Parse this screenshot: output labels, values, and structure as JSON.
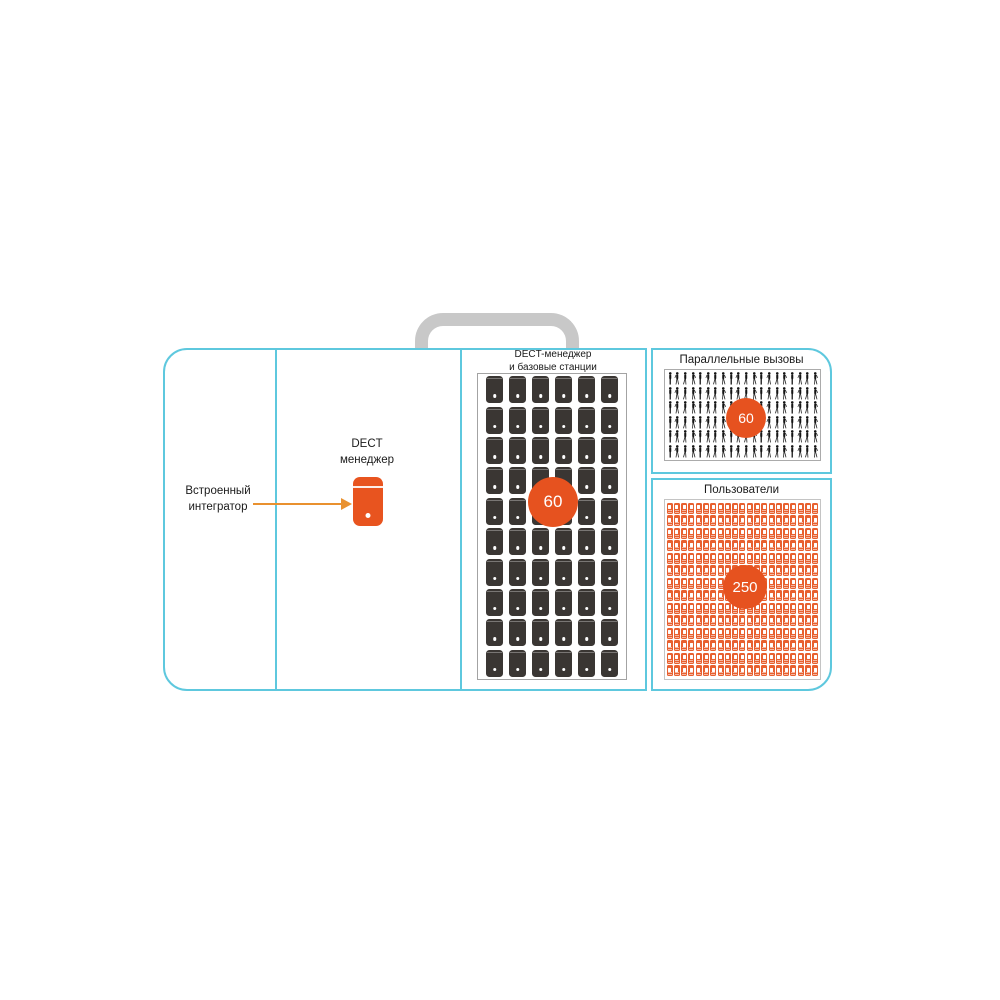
{
  "colors": {
    "accent_orange": "#E6521F",
    "arrow_orange": "#E9912F",
    "case_cyan": "#5EC8DE",
    "handle_gray": "#C8C8C8",
    "base_station_dark": "#3A3633",
    "handset_orange": "#E8602F"
  },
  "integrator": {
    "line1": "Встроенный",
    "line2": "интегратор",
    "arrow_icon": "right-arrow-icon"
  },
  "dect_manager": {
    "line1": "DECT",
    "line2": "менеджер",
    "icon": "dect-manager-device-icon"
  },
  "base_stations_panel": {
    "title_line1": "DECT-менеджер",
    "title_line2": "и базовые станции",
    "count_badge": "60",
    "grid": {
      "columns": 6,
      "rows": 10,
      "total_icons": 60,
      "icon": "base-station-icon"
    }
  },
  "parallel_calls_panel": {
    "title": "Параллельные вызовы",
    "count_badge": "60",
    "grid": {
      "columns": 20,
      "rows": 6,
      "total_icons": 120,
      "icon": "person-icon"
    }
  },
  "users_panel": {
    "title": "Пользователи",
    "count_badge": "250",
    "grid": {
      "columns": 21,
      "rows": 14,
      "total_icons": 294,
      "icon": "handset-icon"
    }
  }
}
